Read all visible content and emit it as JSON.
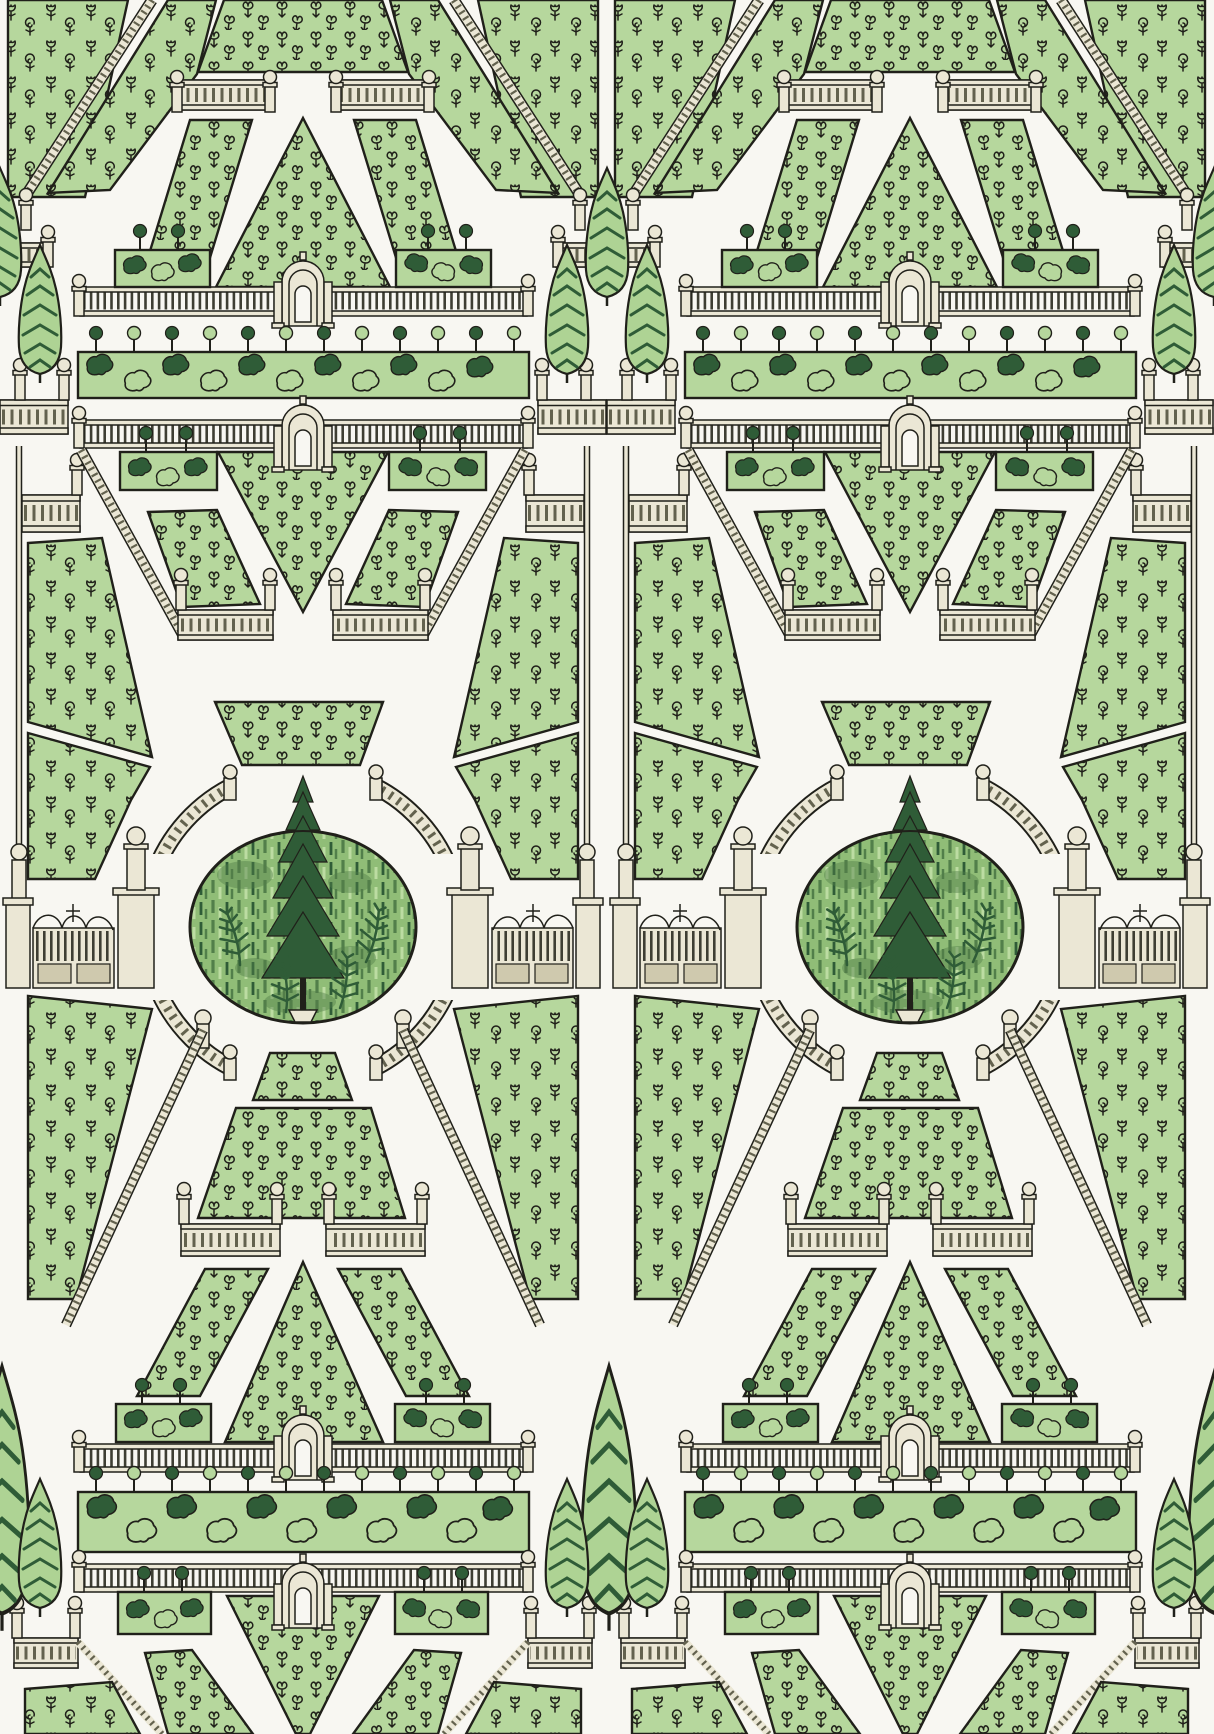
{
  "artwork": {
    "description": "Wallpaper pattern of a formal parterre garden plan in engraved botanical style: symmetrical trapezoid, triangle and parallelogram planting beds drawn with tiny sprig and tulip motifs, cream stone balustrades, staircase railings, fences with arched garden pavilions, clipped topiary hedge bands, iron gates, a circular balustrade enclosing an oval lawn with a central spruce and four ferns, and columns of tall cypress trees between repeats",
    "style": "hand-drawn engraving with flat green fills on off-white ground",
    "repeat": {
      "columns": 2,
      "tile_width_px": 607,
      "canvas_width_px": 1214,
      "canvas_height_px": 1734
    }
  },
  "palette": {
    "background": "#f8f7f2",
    "bed_green": "#b6d79d",
    "foliage_dark": "#2f5c37",
    "foliage_mid": "#527f4a",
    "grass_base": "#90bd77",
    "grass_light": "#bcdca2",
    "cypress_light": "#aed394",
    "cream": "#ebe7d5",
    "cream_shade": "#cfc9ae",
    "ink": "#20201a",
    "slat_dark": "#3e3e33"
  },
  "inventory": {
    "garden_tiles": 2,
    "cypress_columns": 3,
    "cypresses_per_column": 6,
    "gates_per_tile": 2,
    "arched_pavilions_per_tile": 4,
    "topiary_hedge_bands_per_tile": 2,
    "central_lawn": "oval lawn, one spruce, four ferns",
    "bed_motifs": [
      "clover sprigs",
      "flowering sprigs",
      "tulips",
      "roses"
    ],
    "architecture": [
      "balustrades",
      "newel posts with ball finials",
      "slat fences",
      "curved circular balustrade",
      "double iron gates",
      "staircase railings"
    ]
  }
}
